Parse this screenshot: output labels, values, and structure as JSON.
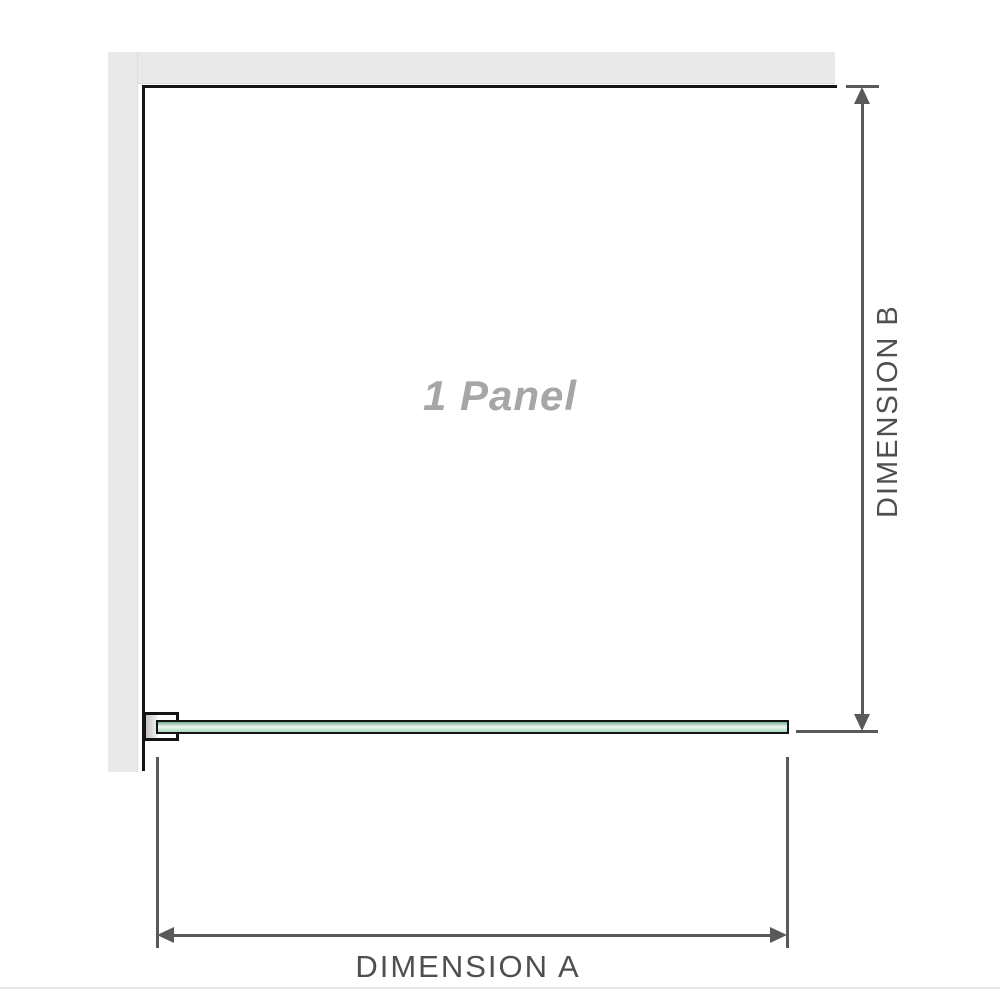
{
  "diagram": {
    "panel_label": "1 Panel",
    "dimension_a_label": "DIMENSION A",
    "dimension_b_label": "DIMENSION B"
  },
  "colors": {
    "background": "#ffffff",
    "wall": "#e9e9e9",
    "outline": "#141414",
    "glass_top": "#72b092",
    "glass_light": "#eef7f1",
    "glass_bottom": "#abd8c0",
    "dimension": "#58595b",
    "label": "#4f4f4f",
    "panel_label": "#a6a6a6",
    "separator": "#e7e7e9"
  }
}
